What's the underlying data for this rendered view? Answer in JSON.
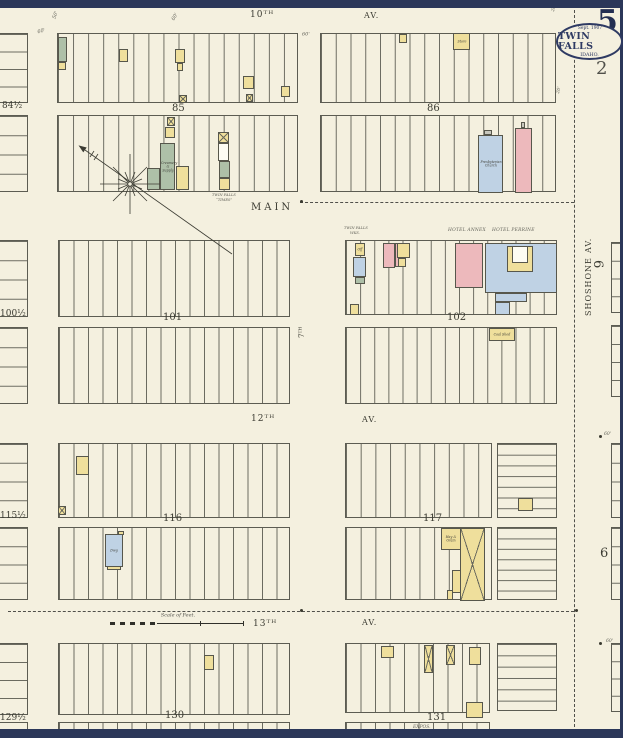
{
  "corner": {
    "sheet_number": "5",
    "adjacent_page": "2",
    "stamp_date": "Sept. 1907",
    "stamp_city": "TWIN FALLS",
    "stamp_state": "IDAHO."
  },
  "scalebar": {
    "label": "Scale of Feet."
  },
  "colors": {
    "y": "#EFDF9C",
    "p": "#EDB9BC",
    "bl": "#BFD2E4",
    "g": "#AEC0A8",
    "w": "#FDFCF3",
    "gr": "#C8C8BE",
    "paper": "#f4f0df",
    "band_navy": "#2b3759",
    "ink": "#3c3c33"
  },
  "blocks": [
    {
      "x": 57,
      "y": 33,
      "w": 241,
      "h": 70,
      "n": 16,
      "d": "v"
    },
    {
      "x": 57,
      "y": 115,
      "w": 241,
      "h": 77,
      "n": 16,
      "d": "v"
    },
    {
      "x": 320,
      "y": 33,
      "w": 236,
      "h": 70,
      "n": 16,
      "d": "v"
    },
    {
      "x": 320,
      "y": 115,
      "w": 236,
      "h": 77,
      "n": 16,
      "d": "v"
    },
    {
      "x": 58,
      "y": 240,
      "w": 232,
      "h": 77,
      "n": 16,
      "d": "v"
    },
    {
      "x": 58,
      "y": 327,
      "w": 232,
      "h": 77,
      "n": 16,
      "d": "v"
    },
    {
      "x": 345,
      "y": 240,
      "w": 212,
      "h": 75,
      "n": 15,
      "d": "v"
    },
    {
      "x": 345,
      "y": 327,
      "w": 212,
      "h": 77,
      "n": 15,
      "d": "v"
    },
    {
      "x": 58,
      "y": 443,
      "w": 232,
      "h": 75,
      "n": 16,
      "d": "v"
    },
    {
      "x": 58,
      "y": 527,
      "w": 232,
      "h": 73,
      "n": 16,
      "d": "v"
    },
    {
      "x": 345,
      "y": 443,
      "w": 147,
      "h": 75,
      "n": 10,
      "d": "v"
    },
    {
      "x": 497,
      "y": 443,
      "w": 60,
      "h": 75,
      "n": 7,
      "d": "h"
    },
    {
      "x": 345,
      "y": 527,
      "w": 147,
      "h": 73,
      "n": 10,
      "d": "v"
    },
    {
      "x": 497,
      "y": 527,
      "w": 60,
      "h": 73,
      "n": 7,
      "d": "h"
    },
    {
      "x": 58,
      "y": 643,
      "w": 232,
      "h": 72,
      "n": 16,
      "d": "v"
    },
    {
      "x": 345,
      "y": 643,
      "w": 145,
      "h": 70,
      "n": 10,
      "d": "v"
    },
    {
      "x": 497,
      "y": 643,
      "w": 60,
      "h": 68,
      "n": 6,
      "d": "h"
    },
    {
      "x": 58,
      "y": 722,
      "w": 232,
      "h": 11,
      "n": 16,
      "d": "v"
    },
    {
      "x": 345,
      "y": 722,
      "w": 145,
      "h": 11,
      "n": 10,
      "d": "v"
    },
    {
      "x": -3,
      "y": 33,
      "w": 31,
      "h": 70,
      "n": 4,
      "d": "h"
    },
    {
      "x": -3,
      "y": 115,
      "w": 31,
      "h": 77,
      "n": 4,
      "d": "h"
    },
    {
      "x": -3,
      "y": 240,
      "w": 31,
      "h": 77,
      "n": 4,
      "d": "h"
    },
    {
      "x": -3,
      "y": 327,
      "w": 31,
      "h": 77,
      "n": 4,
      "d": "h"
    },
    {
      "x": -3,
      "y": 443,
      "w": 31,
      "h": 75,
      "n": 4,
      "d": "h"
    },
    {
      "x": -3,
      "y": 527,
      "w": 31,
      "h": 73,
      "n": 4,
      "d": "h"
    },
    {
      "x": -3,
      "y": 643,
      "w": 31,
      "h": 72,
      "n": 4,
      "d": "h"
    },
    {
      "x": -3,
      "y": 722,
      "w": 31,
      "h": 11,
      "n": 1,
      "d": "h"
    },
    {
      "x": 611,
      "y": 242,
      "w": 14,
      "h": 71,
      "n": 4,
      "d": "h"
    },
    {
      "x": 611,
      "y": 325,
      "w": 14,
      "h": 72,
      "n": 4,
      "d": "h"
    },
    {
      "x": 611,
      "y": 443,
      "w": 14,
      "h": 75,
      "n": 4,
      "d": "h"
    },
    {
      "x": 611,
      "y": 527,
      "w": 14,
      "h": 73,
      "n": 4,
      "d": "h"
    },
    {
      "x": 611,
      "y": 643,
      "w": 14,
      "h": 69,
      "n": 4,
      "d": "h"
    }
  ],
  "buildings": [
    {
      "x": 58,
      "y": 37,
      "w": 9,
      "h": 25,
      "c": "g"
    },
    {
      "x": 58,
      "y": 62,
      "w": 8,
      "h": 8,
      "c": "y"
    },
    {
      "x": 119,
      "y": 49,
      "w": 9,
      "h": 13,
      "c": "y"
    },
    {
      "x": 175,
      "y": 49,
      "w": 10,
      "h": 14,
      "c": "y"
    },
    {
      "x": 177,
      "y": 63,
      "w": 6,
      "h": 8,
      "c": "y"
    },
    {
      "x": 243,
      "y": 76,
      "w": 11,
      "h": 13,
      "c": "y"
    },
    {
      "x": 246,
      "y": 94,
      "w": 7,
      "h": 8,
      "c": "y",
      "cx": true
    },
    {
      "x": 179,
      "y": 95,
      "w": 8,
      "h": 8,
      "c": "y",
      "cx": true
    },
    {
      "x": 281,
      "y": 86,
      "w": 9,
      "h": 11,
      "c": "y"
    },
    {
      "x": 399,
      "y": 34,
      "w": 8,
      "h": 9,
      "c": "y"
    },
    {
      "x": 453,
      "y": 33,
      "w": 17,
      "h": 17,
      "c": "y",
      "l": "Store"
    },
    {
      "x": 167,
      "y": 117,
      "w": 8,
      "h": 9,
      "c": "y",
      "cx": true
    },
    {
      "x": 165,
      "y": 127,
      "w": 10,
      "h": 11,
      "c": "y"
    },
    {
      "x": 160,
      "y": 143,
      "w": 15,
      "h": 47,
      "c": "g",
      "l": "Creamery & Supply"
    },
    {
      "x": 147,
      "y": 168,
      "w": 13,
      "h": 22,
      "c": "g"
    },
    {
      "x": 176,
      "y": 166,
      "w": 13,
      "h": 24,
      "c": "y"
    },
    {
      "x": 218,
      "y": 132,
      "w": 11,
      "h": 11,
      "c": "y",
      "cx": true
    },
    {
      "x": 218,
      "y": 143,
      "w": 11,
      "h": 18,
      "c": "w"
    },
    {
      "x": 219,
      "y": 161,
      "w": 11,
      "h": 17,
      "c": "g"
    },
    {
      "x": 219,
      "y": 178,
      "w": 11,
      "h": 12,
      "c": "y"
    },
    {
      "x": 484,
      "y": 130,
      "w": 8,
      "h": 5,
      "c": "gr"
    },
    {
      "x": 478,
      "y": 135,
      "w": 25,
      "h": 58,
      "c": "bl",
      "l": "Presbyterian Church"
    },
    {
      "x": 521,
      "y": 122,
      "w": 4,
      "h": 6,
      "c": "gr"
    },
    {
      "x": 515,
      "y": 128,
      "w": 17,
      "h": 65,
      "c": "p"
    },
    {
      "x": 355,
      "y": 243,
      "w": 10,
      "h": 13,
      "c": "y",
      "l": "Off"
    },
    {
      "x": 353,
      "y": 257,
      "w": 13,
      "h": 20,
      "c": "bl"
    },
    {
      "x": 355,
      "y": 277,
      "w": 10,
      "h": 7,
      "c": "g"
    },
    {
      "x": 383,
      "y": 243,
      "w": 12,
      "h": 25,
      "c": "p"
    },
    {
      "x": 395,
      "y": 243,
      "w": 6,
      "h": 24,
      "c": "p"
    },
    {
      "x": 397,
      "y": 243,
      "w": 13,
      "h": 15,
      "c": "y"
    },
    {
      "x": 398,
      "y": 258,
      "w": 8,
      "h": 9,
      "c": "y"
    },
    {
      "x": 455,
      "y": 243,
      "w": 28,
      "h": 45,
      "c": "p"
    },
    {
      "x": 485,
      "y": 243,
      "w": 72,
      "h": 50,
      "c": "bl"
    },
    {
      "x": 507,
      "y": 246,
      "w": 26,
      "h": 26,
      "c": "y"
    },
    {
      "x": 512,
      "y": 246,
      "w": 16,
      "h": 17,
      "c": "w"
    },
    {
      "x": 495,
      "y": 293,
      "w": 32,
      "h": 9,
      "c": "bl"
    },
    {
      "x": 495,
      "y": 302,
      "w": 15,
      "h": 13,
      "c": "bl"
    },
    {
      "x": 350,
      "y": 304,
      "w": 9,
      "h": 11,
      "c": "y"
    },
    {
      "x": 489,
      "y": 328,
      "w": 26,
      "h": 13,
      "c": "y",
      "l": "Coal Shed"
    },
    {
      "x": 76,
      "y": 456,
      "w": 13,
      "h": 19,
      "c": "y"
    },
    {
      "x": 58,
      "y": 506,
      "w": 8,
      "h": 9,
      "c": "y",
      "cx": true
    },
    {
      "x": 118,
      "y": 531,
      "w": 6,
      "h": 4,
      "c": "y"
    },
    {
      "x": 105,
      "y": 534,
      "w": 18,
      "h": 33,
      "c": "bl",
      "l": "Dwg"
    },
    {
      "x": 107,
      "y": 566,
      "w": 14,
      "h": 4,
      "c": "y"
    },
    {
      "x": 518,
      "y": 498,
      "w": 15,
      "h": 13,
      "c": "y"
    },
    {
      "x": 441,
      "y": 528,
      "w": 20,
      "h": 22,
      "c": "y",
      "l": "Hay & Grain"
    },
    {
      "x": 460,
      "y": 528,
      "w": 25,
      "h": 73,
      "c": "y",
      "cx": true
    },
    {
      "x": 452,
      "y": 570,
      "w": 9,
      "h": 23,
      "c": "y"
    },
    {
      "x": 447,
      "y": 590,
      "w": 6,
      "h": 10,
      "c": "y"
    },
    {
      "x": 204,
      "y": 655,
      "w": 10,
      "h": 15,
      "c": "y"
    },
    {
      "x": 381,
      "y": 646,
      "w": 13,
      "h": 12,
      "c": "y"
    },
    {
      "x": 424,
      "y": 645,
      "w": 9,
      "h": 28,
      "c": "y",
      "cx": true
    },
    {
      "x": 446,
      "y": 645,
      "w": 9,
      "h": 20,
      "c": "y",
      "cx": true
    },
    {
      "x": 469,
      "y": 647,
      "w": 12,
      "h": 18,
      "c": "y"
    },
    {
      "x": 466,
      "y": 702,
      "w": 17,
      "h": 16,
      "c": "y"
    }
  ],
  "labels": [
    {
      "k": "s",
      "t": "10ᵀᴴ",
      "x": 250,
      "y": 11,
      "fs": 9,
      "ls": 1
    },
    {
      "k": "s",
      "t": "AV.",
      "x": 364,
      "y": 12,
      "fs": 8,
      "ls": 1
    },
    {
      "k": "s",
      "t": "MAIN",
      "x": 251,
      "y": 203,
      "fs": 10,
      "ls": 3
    },
    {
      "k": "s",
      "t": "12ᵀᴴ",
      "x": 251,
      "y": 415,
      "fs": 9,
      "ls": 1
    },
    {
      "k": "s",
      "t": "AV.",
      "x": 362,
      "y": 416,
      "fs": 8,
      "ls": 1
    },
    {
      "k": "s",
      "t": "13ᵀᴴ",
      "x": 253,
      "y": 620,
      "fs": 9,
      "ls": 1
    },
    {
      "k": "s",
      "t": "AV.",
      "x": 362,
      "y": 619,
      "fs": 8,
      "ls": 1
    },
    {
      "k": "s",
      "t": "SHOSHONE",
      "x": 585,
      "y": 316,
      "fs": 8,
      "rot": -90,
      "ls": 1
    },
    {
      "k": "s",
      "t": "AV.",
      "x": 585,
      "y": 253,
      "fs": 8,
      "rot": -90,
      "ls": 1
    },
    {
      "k": "s",
      "t": "7ᵀᴴ",
      "x": 299,
      "y": 338,
      "fs": 7,
      "rot": -90
    },
    {
      "k": "n",
      "t": "85",
      "x": 172,
      "y": 104,
      "fs": 10
    },
    {
      "k": "n",
      "t": "86",
      "x": 427,
      "y": 104,
      "fs": 10
    },
    {
      "k": "n",
      "t": "101",
      "x": 163,
      "y": 313,
      "fs": 10
    },
    {
      "k": "n",
      "t": "102",
      "x": 447,
      "y": 313,
      "fs": 10
    },
    {
      "k": "n",
      "t": "116",
      "x": 163,
      "y": 514,
      "fs": 10
    },
    {
      "k": "n",
      "t": "117",
      "x": 423,
      "y": 514,
      "fs": 10
    },
    {
      "k": "n",
      "t": "130",
      "x": 165,
      "y": 711,
      "fs": 10
    },
    {
      "k": "n",
      "t": "131",
      "x": 427,
      "y": 713,
      "fs": 10
    },
    {
      "k": "n",
      "t": "84½",
      "x": 2,
      "y": 102,
      "fs": 9
    },
    {
      "k": "n",
      "t": "100½",
      "x": 0,
      "y": 310,
      "fs": 9
    },
    {
      "k": "n",
      "t": "115½",
      "x": 0,
      "y": 512,
      "fs": 9
    },
    {
      "k": "n",
      "t": "129½",
      "x": 0,
      "y": 714,
      "fs": 9
    },
    {
      "k": "n",
      "t": "6",
      "x": 604,
      "y": 260,
      "fs": 13,
      "rot": 90
    },
    {
      "k": "n",
      "t": "6",
      "x": 600,
      "y": 547,
      "fs": 13
    },
    {
      "k": "a",
      "t": "TWIN FALLS",
      "x": 212,
      "y": 193,
      "fs": 3.6
    },
    {
      "k": "a",
      "t": "“TIMES”",
      "x": 216,
      "y": 198,
      "fs": 3.6
    },
    {
      "k": "a",
      "t": "TWIN FALLS",
      "x": 344,
      "y": 226,
      "fs": 3.6
    },
    {
      "k": "a",
      "t": "WKS.",
      "x": 350,
      "y": 231,
      "fs": 3.6
    },
    {
      "k": "a",
      "t": "HOTEL ANNEX",
      "x": 448,
      "y": 228,
      "fs": 4.4,
      "ls": 0.5
    },
    {
      "k": "a",
      "t": "HOTEL PERRINE",
      "x": 492,
      "y": 228,
      "fs": 4.4,
      "ls": 0.5
    },
    {
      "k": "a",
      "t": "EXPOS.",
      "x": 413,
      "y": 725,
      "fs": 4.5
    },
    {
      "k": "a",
      "t": "50'",
      "x": 52,
      "y": 18,
      "fs": 5,
      "rot": -70
    },
    {
      "k": "a",
      "t": "60'",
      "x": 37,
      "y": 30,
      "fs": 5,
      "rot": -15
    },
    {
      "k": "a",
      "t": "60'",
      "x": 171,
      "y": 19,
      "fs": 5,
      "rot": -60
    },
    {
      "k": "a",
      "t": "60'",
      "x": 302,
      "y": 32,
      "fs": 5
    },
    {
      "k": "a",
      "t": "20'",
      "x": 551,
      "y": 11,
      "fs": 4.5,
      "rot": -75
    },
    {
      "k": "a",
      "t": "20'",
      "x": 556,
      "y": 93,
      "fs": 4.5,
      "rot": -75
    },
    {
      "k": "a",
      "t": "60'",
      "x": 604,
      "y": 432,
      "fs": 4.5
    },
    {
      "k": "a",
      "t": "60'",
      "x": 606,
      "y": 639,
      "fs": 4.5
    }
  ],
  "lines": [
    {
      "x": 574,
      "y": 10,
      "len": 722,
      "d": "v"
    },
    {
      "x": 300,
      "y": 202,
      "len": 274,
      "d": "h"
    },
    {
      "x": 8,
      "y": 611,
      "len": 566,
      "d": "h"
    }
  ],
  "dots": [
    {
      "x": 300,
      "y": 200
    },
    {
      "x": 300,
      "y": 609
    },
    {
      "x": 575,
      "y": 609
    },
    {
      "x": 599,
      "y": 435
    },
    {
      "x": 599,
      "y": 642
    }
  ]
}
